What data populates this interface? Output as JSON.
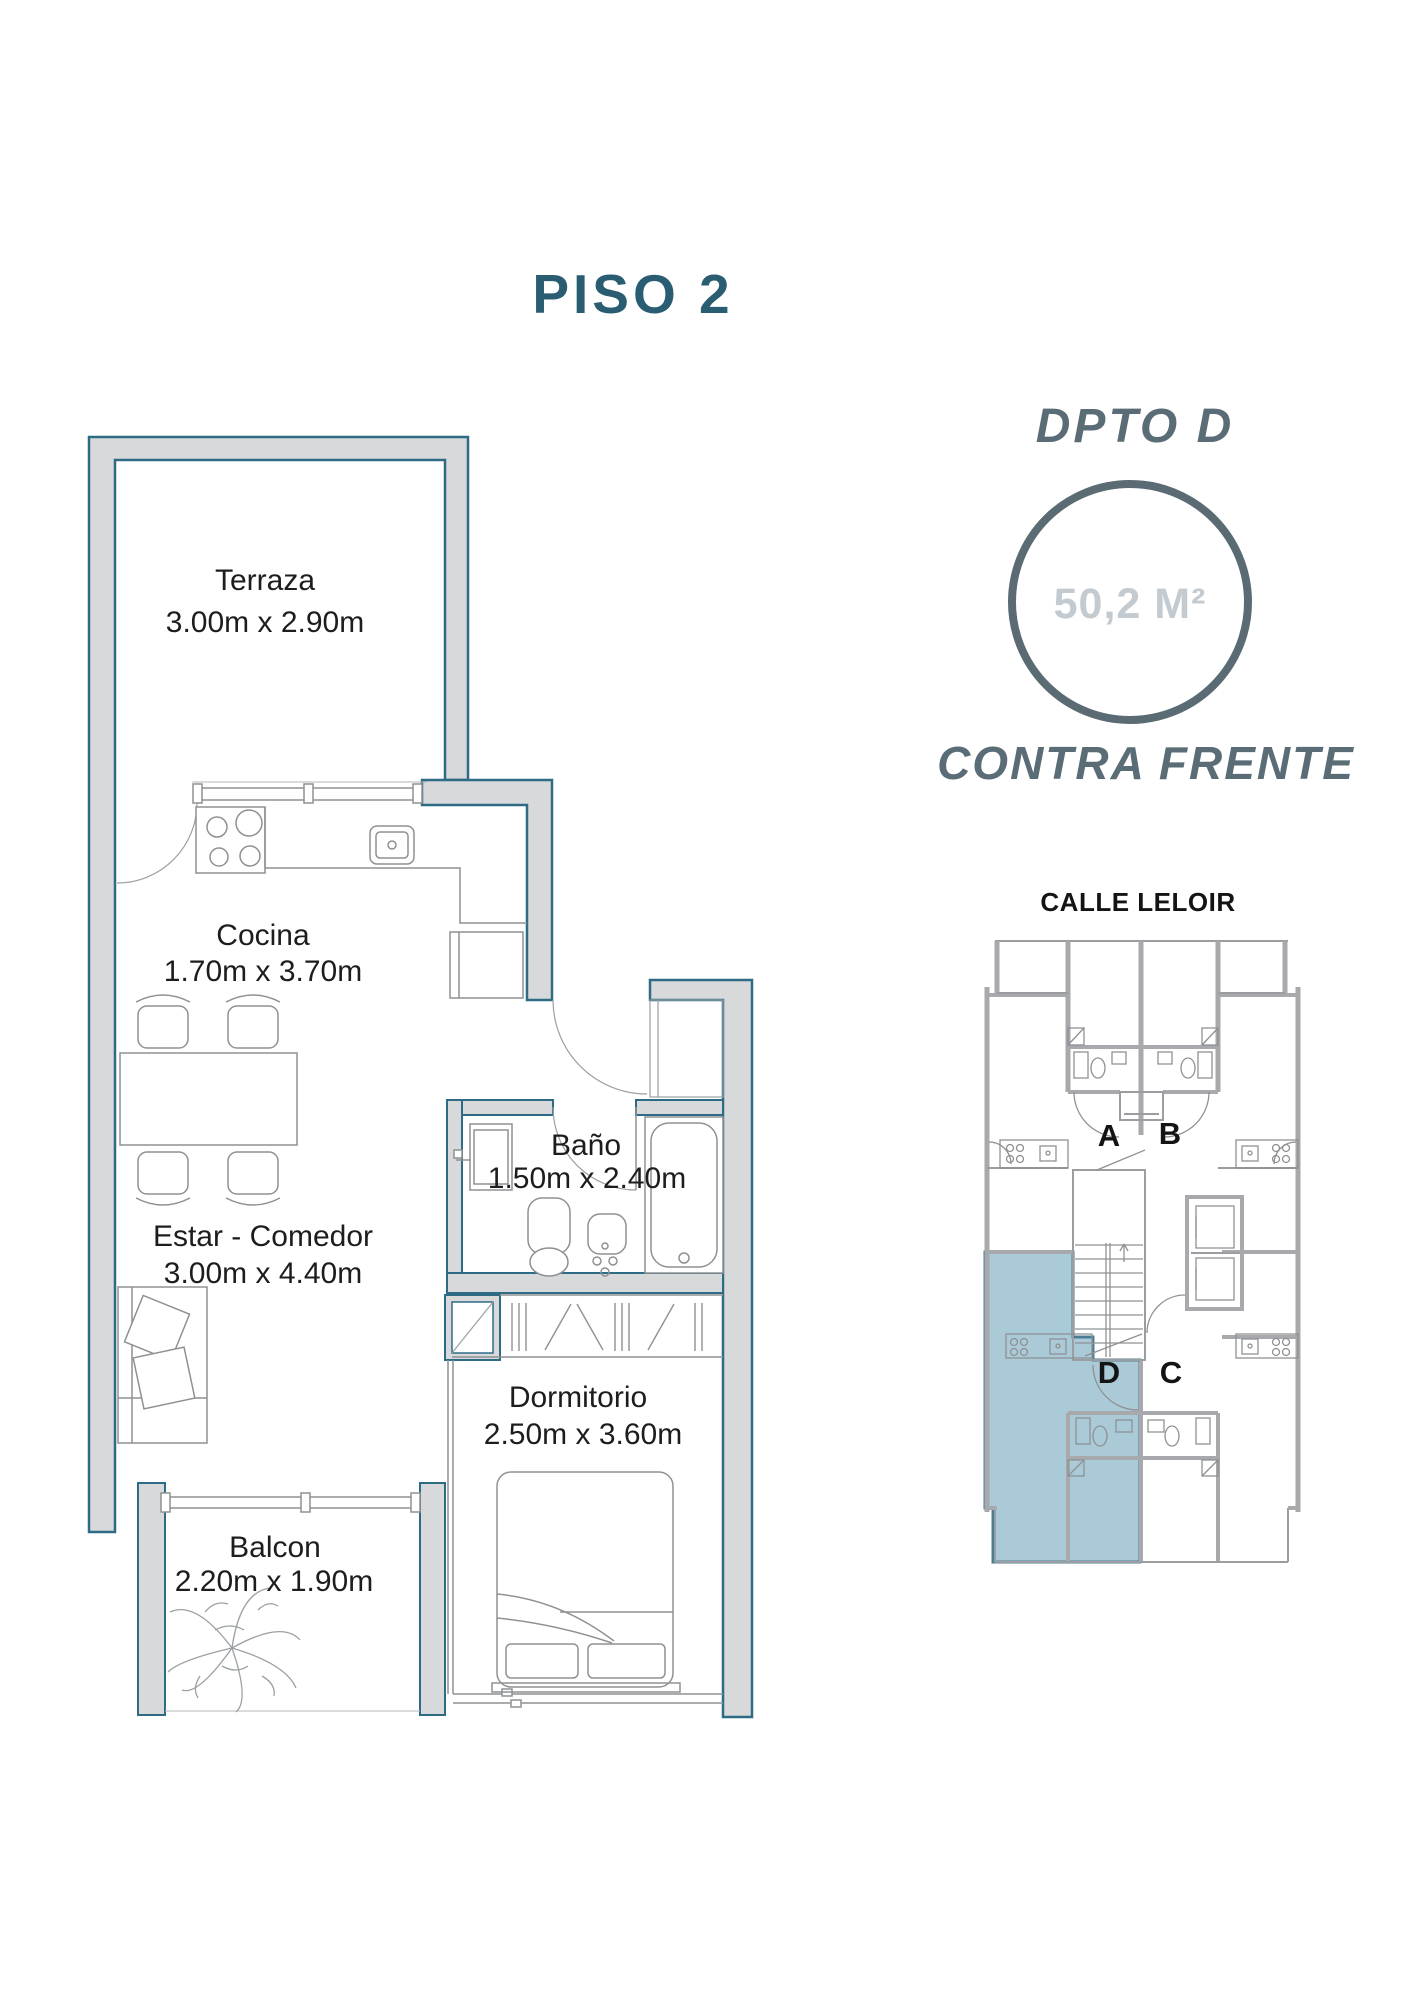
{
  "page": {
    "title": "PISO 2"
  },
  "unit": {
    "name": "DPTO D",
    "area": "50,2 M²",
    "orientation": "CONTRA FRENTE"
  },
  "key_plan": {
    "street": "CALLE LELOIR",
    "units": [
      "A",
      "B",
      "C",
      "D"
    ],
    "highlighted_unit": "D"
  },
  "rooms": [
    {
      "name": "Terraza",
      "dims": "3.00m x 2.90m"
    },
    {
      "name": "Cocina",
      "dims": "1.70m x 3.70m"
    },
    {
      "name": "Estar - Comedor",
      "dims": "3.00m x 4.40m"
    },
    {
      "name": "Baño",
      "dims": "1.50m x 2.40m"
    },
    {
      "name": "Dormitorio",
      "dims": "2.50m x 3.60m"
    },
    {
      "name": "Balcon",
      "dims": "2.20m x 1.90m"
    }
  ],
  "colors": {
    "title_teal": "#2a5d72",
    "slate": "#5a6d76",
    "area_text": "#c3cad0",
    "wall_outline": "#2e6b85",
    "wall_fill": "#d8d9db",
    "keyplan_wall": "#a7a9ac",
    "keyplan_highlight": "#abcad7",
    "keyplan_highlight_border": "#4b7e96",
    "label_text": "#1d1d1f"
  }
}
